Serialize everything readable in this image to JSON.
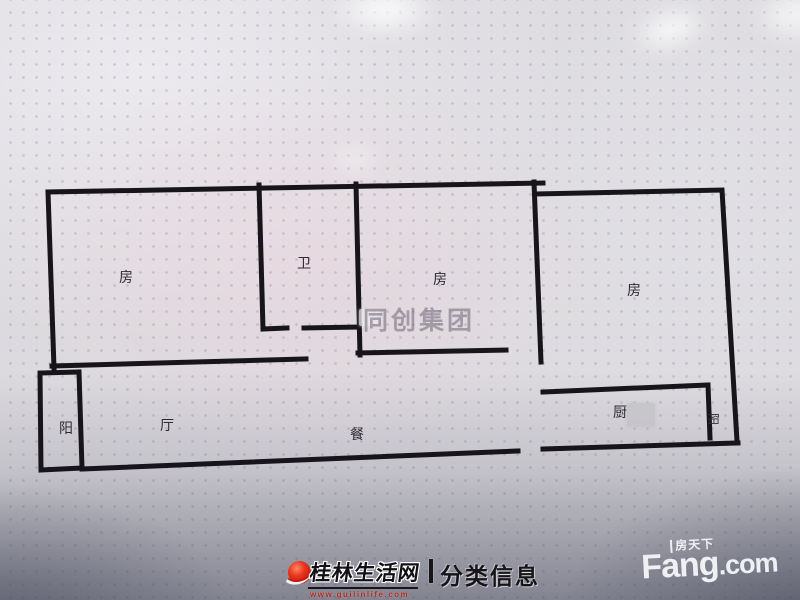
{
  "floorplan": {
    "labels": {
      "room_left": "房",
      "bath": "卫",
      "room_middle": "房",
      "room_right": "房",
      "balcony_left": "阳",
      "hall": "厅",
      "dining": "餐",
      "kitchen": "厨",
      "balcony_right": "阳"
    },
    "watermark": "同创集团"
  },
  "footer": {
    "guilinlife": {
      "site_name": "桂林生活网",
      "site_url": "www.guilinlife.com",
      "section": "分类信息"
    },
    "fang": {
      "brand_cn": "房天下",
      "brand_en": "Fang",
      "brand_suffix": ".com"
    }
  },
  "colors": {
    "wall": "#17141a",
    "brand_red": "#d6281a",
    "background": "#dcdade",
    "footer_dark": "#6b6e7c"
  }
}
